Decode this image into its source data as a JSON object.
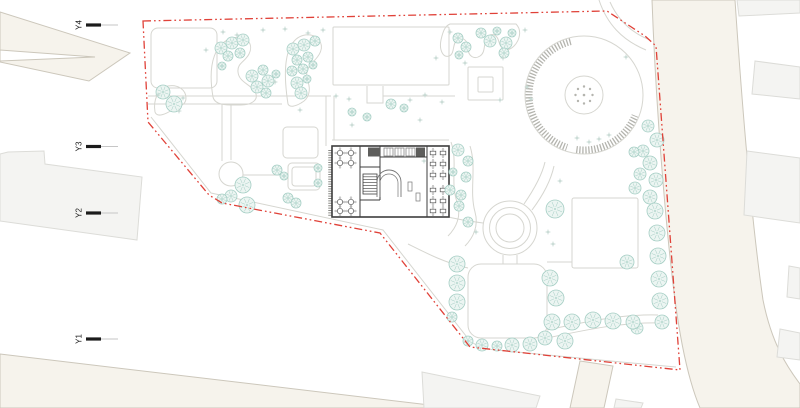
{
  "scene": {
    "width": 800,
    "height": 408,
    "bg": "#ffffff",
    "title": "architectural-site-plan"
  },
  "colors": {
    "boundary": "#e04138",
    "road_fill": "#f6f3ec",
    "road_stroke": "#ccc7bb",
    "building_fill": "#f4f4f2",
    "building_stroke": "#dcdcd8",
    "path_stroke": "#d6d6d0",
    "tree_stroke": "#a3cdc3",
    "tree_fill": "#ecf5f2",
    "sparkle": "#c6d9d3",
    "plan_stroke": "#3d3d3d",
    "plan_mid": "#777777",
    "hatch": "#b4b4ae",
    "marker": "#1b1b1b",
    "marker_line": "#c6c6c6"
  },
  "markers": [
    {
      "label": "Y4",
      "x": 79,
      "y": 25
    },
    {
      "label": "Y3",
      "x": 79,
      "y": 146.5
    },
    {
      "label": "Y2",
      "x": 79,
      "y": 213
    },
    {
      "label": "Y1",
      "x": 79,
      "y": 339
    }
  ],
  "boundary": "M143,21 L607,11 L645,36 L656,46 L680,370 L470,347 L380,233 L222,203 L209,195 L148,122 Z",
  "roads": [
    {
      "d": "M0,12 L130,53 L89,81 L0,62 Z M0,50 L95,57 L0,61 Z",
      "rule": "evenodd"
    },
    {
      "d": "M0,354 L455,408 L0,408 Z"
    },
    {
      "d": "M652,0 L735,0 C741,90 750,210 763,300 C772,345 788,368 800,384 L800,408 L700,408 C689,382 681,345 675,300 C666,230 656,110 652,0 Z"
    },
    {
      "d": "M580,361 L613,366 L604,408 L570,408 Z"
    }
  ],
  "offsite_buildings": [
    "M8,152 L44,151 L45,164 L142,177 L137,240 L0,221 L0,154 Z",
    "M422,372 L540,396 L536,408 L424,408 Z",
    "M616,399 L643,403 L641,408 L614,408 Z",
    "M737,0 L800,0 L800,13 L739,16 Z",
    "M755,61 L800,67 L800,99 L752,94 Z",
    "M747,151 L800,158 L800,223 L744,215 Z",
    "M789,266 L800,268 L800,299 L787,297 Z",
    "M780,329 L800,333 L800,360 L777,357 Z"
  ],
  "paths": [
    "M151,117 L211,193 L383,230 L470,341 Q481,349 496,350 L600,360 L676,367",
    "M148,96 H331",
    "M148,104 H282",
    "M222,104 V161",
    "M231,104 V160",
    "M243,175 H283",
    "M326,96 V146",
    "M334,96 V140",
    "M332,140 H449",
    "M367,86 V103 H383 V86",
    "M383,96 H455",
    "M503,255 V264 M517,255 V264",
    "M547,330 C585,322 620,314 658,315",
    "M547,338 C585,330 622,322 660,323",
    "M483,223 C468,221 456,219 449,217",
    "M524,204 C535,188 542,175 545,162",
    "M532,210 C544,194 551,180 554,166",
    "M547,262 H572",
    "M468,268 C445,263 424,252 408,244",
    "M610,2 C618,20 632,33 650,40",
    "M599,0 C607,24 622,40 646,50",
    "M451,142 C458,162 450,182 457,202 C462,216 456,228 448,236",
    "M470,146 C477,168 469,190 475,212 C479,226 473,238 465,246",
    "M213,97 C207,62 216,42 233,38 C247,35 254,44 249,54 C245,62 237,63 238,72 C239,83 252,84 256,94 C258,101 250,105 241,105 C228,105 215,106 213,97 Z",
    "M288,104 C284,78 284,56 292,44 C299,33 313,32 319,40 C325,48 319,56 313,62 C307,68 305,74 308,82 C311,90 309,99 301,103 C296,106 290,108 288,104 Z",
    "M450,24 L516,24 C522,30 520,40 514,46 C508,52 501,50 499,42 C497,34 491,32 487,38 C483,44 486,52 480,56 C474,60 468,56 468,48 C468,40 462,36 457,40 C452,44 455,54 449,56 C443,58 439,50 441,40 C443,31 445,26 450,24 Z",
    "M155,112 C153,100 158,88 168,86 C178,84 186,90 186,98 C186,106 178,106 172,110 C166,114 157,118 155,112 Z"
  ],
  "rects": [
    {
      "x": 151,
      "y": 28,
      "w": 66,
      "h": 60,
      "rx": 7
    },
    {
      "x": 283,
      "y": 127,
      "w": 35,
      "h": 31,
      "rx": 4
    },
    {
      "x": 288,
      "y": 163,
      "w": 32,
      "h": 27,
      "rx": 4
    },
    {
      "x": 292,
      "y": 167,
      "w": 24,
      "h": 19,
      "rx": 3
    },
    {
      "x": 333,
      "y": 27,
      "w": 116,
      "h": 58,
      "rx": 1
    },
    {
      "x": 468,
      "y": 67,
      "w": 35,
      "h": 33,
      "rx": 1
    },
    {
      "x": 478,
      "y": 77,
      "w": 15,
      "h": 15,
      "rx": 1
    },
    {
      "x": 468,
      "y": 264,
      "w": 79,
      "h": 74,
      "rx": 13
    },
    {
      "x": 572,
      "y": 198,
      "w": 66,
      "h": 70,
      "rx": 2
    }
  ],
  "circles": [
    {
      "cx": 231,
      "cy": 174,
      "r": 12
    }
  ],
  "plaza": {
    "cx": 584,
    "cy": 95,
    "r": 59,
    "inner_r": 19,
    "dots_r": 8.5,
    "dot_count": 8,
    "arcs": [
      [
        55,
        104,
        252
      ],
      [
        55,
        262,
        338
      ]
    ]
  },
  "fountain": {
    "cx": 510,
    "cy": 228,
    "radii": [
      27,
      20.5,
      14
    ]
  },
  "trees": [
    [
      163,
      92,
      7
    ],
    [
      174,
      104,
      8
    ],
    [
      221,
      48,
      6
    ],
    [
      232,
      43,
      6
    ],
    [
      243,
      40,
      6
    ],
    [
      228,
      56,
      5
    ],
    [
      240,
      53,
      5
    ],
    [
      222,
      66,
      4
    ],
    [
      252,
      76,
      6
    ],
    [
      263,
      70,
      5
    ],
    [
      257,
      87,
      6
    ],
    [
      268,
      81,
      6
    ],
    [
      266,
      93,
      5
    ],
    [
      276,
      74,
      4
    ],
    [
      293,
      49,
      6
    ],
    [
      304,
      45,
      6
    ],
    [
      315,
      41,
      5
    ],
    [
      297,
      60,
      5
    ],
    [
      308,
      57,
      5
    ],
    [
      292,
      71,
      5
    ],
    [
      303,
      69,
      5
    ],
    [
      313,
      65,
      4
    ],
    [
      297,
      83,
      6
    ],
    [
      307,
      79,
      4
    ],
    [
      301,
      93,
      6
    ],
    [
      352,
      112,
      4
    ],
    [
      367,
      117,
      4
    ],
    [
      391,
      104,
      5
    ],
    [
      404,
      108,
      4
    ],
    [
      458,
      38,
      5
    ],
    [
      466,
      47,
      5
    ],
    [
      459,
      55,
      4
    ],
    [
      481,
      33,
      5
    ],
    [
      490,
      41,
      6
    ],
    [
      497,
      31,
      4
    ],
    [
      506,
      43,
      6
    ],
    [
      512,
      33,
      4
    ],
    [
      504,
      53,
      5
    ],
    [
      458,
      150,
      6
    ],
    [
      468,
      161,
      5
    ],
    [
      453,
      172,
      4
    ],
    [
      466,
      177,
      5
    ],
    [
      450,
      190,
      5
    ],
    [
      461,
      195,
      5
    ],
    [
      459,
      206,
      5
    ],
    [
      468,
      222,
      5
    ],
    [
      555,
      209,
      9
    ],
    [
      648,
      126,
      6
    ],
    [
      657,
      140,
      7
    ],
    [
      643,
      151,
      6
    ],
    [
      634,
      152,
      5
    ],
    [
      650,
      163,
      7
    ],
    [
      640,
      174,
      6
    ],
    [
      656,
      180,
      7
    ],
    [
      635,
      188,
      6
    ],
    [
      650,
      197,
      7
    ],
    [
      655,
      211,
      8
    ],
    [
      657,
      233,
      8
    ],
    [
      658,
      256,
      8
    ],
    [
      627,
      262,
      7
    ],
    [
      659,
      279,
      8
    ],
    [
      660,
      301,
      8
    ],
    [
      662,
      322,
      7
    ],
    [
      637,
      328,
      6
    ],
    [
      457,
      264,
      8
    ],
    [
      457,
      283,
      8
    ],
    [
      457,
      302,
      8
    ],
    [
      452,
      317,
      5
    ],
    [
      468,
      341,
      5
    ],
    [
      482,
      345,
      6
    ],
    [
      497,
      346,
      5
    ],
    [
      512,
      345,
      7
    ],
    [
      530,
      344,
      7
    ],
    [
      545,
      338,
      7
    ],
    [
      565,
      341,
      8
    ],
    [
      552,
      322,
      8
    ],
    [
      572,
      322,
      8
    ],
    [
      593,
      320,
      8
    ],
    [
      613,
      321,
      8
    ],
    [
      633,
      322,
      7
    ],
    [
      550,
      278,
      8
    ],
    [
      556,
      298,
      8
    ],
    [
      277,
      170,
      5
    ],
    [
      284,
      176,
      4
    ],
    [
      243,
      185,
      8
    ],
    [
      231,
      196,
      6
    ],
    [
      247,
      205,
      8
    ],
    [
      222,
      199,
      5
    ],
    [
      288,
      198,
      5
    ],
    [
      296,
      203,
      5
    ],
    [
      318,
      168,
      4
    ],
    [
      318,
      183,
      4
    ]
  ],
  "sparkles": [
    [
      158,
      95
    ],
    [
      183,
      98
    ],
    [
      179,
      111
    ],
    [
      206,
      50
    ],
    [
      223,
      32
    ],
    [
      237,
      35
    ],
    [
      263,
      30
    ],
    [
      285,
      29
    ],
    [
      308,
      33
    ],
    [
      323,
      30
    ],
    [
      275,
      82
    ],
    [
      336,
      96
    ],
    [
      349,
      99
    ],
    [
      410,
      100
    ],
    [
      425,
      95
    ],
    [
      442,
      102
    ],
    [
      450,
      32
    ],
    [
      525,
      30
    ],
    [
      503,
      58
    ],
    [
      465,
      63
    ],
    [
      500,
      100
    ],
    [
      527,
      87
    ],
    [
      531,
      99
    ],
    [
      577,
      138
    ],
    [
      589,
      142
    ],
    [
      599,
      139
    ],
    [
      609,
      135
    ],
    [
      626,
      57
    ],
    [
      548,
      232
    ],
    [
      553,
      244
    ],
    [
      476,
      232
    ],
    [
      424,
      161
    ],
    [
      560,
      181
    ],
    [
      436,
      58
    ],
    [
      420,
      120
    ],
    [
      352,
      125
    ],
    [
      300,
      110
    ]
  ],
  "plan": {
    "outer": [
      332,
      146,
      117,
      71
    ],
    "hedge": "M330,150 V216",
    "walls": [
      "M360,146 V217",
      "M380,146 V200",
      "M360,167 H380",
      "M380,157 H427",
      "M427,146 V217",
      "M360,200 H380"
    ],
    "stair_block": [
      363,
      174,
      14,
      20
    ],
    "stair_steps": 7,
    "counters": [
      [
        384,
        148,
        9,
        8
      ],
      [
        395,
        148,
        9,
        8
      ],
      [
        406,
        148,
        9,
        8
      ]
    ],
    "dark_blocks": [
      [
        368,
        147.5,
        12,
        9
      ],
      [
        416,
        147.5,
        9,
        9
      ]
    ],
    "arch": "M377,197 V182 A12,12 0 0 1 401,182 V197",
    "arch2": "M380,197 V183 A9,9 0 0 1 398,183 V197",
    "small_rects": [
      [
        408,
        182,
        4,
        9
      ],
      [
        416,
        193,
        4,
        8
      ]
    ],
    "round_tables": [
      [
        340,
        153
      ],
      [
        351,
        153
      ],
      [
        340,
        163
      ],
      [
        351,
        163
      ],
      [
        340,
        202
      ],
      [
        351,
        202
      ],
      [
        340,
        211
      ],
      [
        351,
        211
      ]
    ],
    "square_tables": [
      [
        433,
        153
      ],
      [
        443,
        153
      ],
      [
        433,
        164
      ],
      [
        443,
        164
      ],
      [
        433,
        175
      ],
      [
        443,
        175
      ],
      [
        433,
        190
      ],
      [
        443,
        190
      ],
      [
        433,
        201
      ],
      [
        443,
        201
      ],
      [
        433,
        211
      ],
      [
        443,
        211
      ]
    ]
  }
}
